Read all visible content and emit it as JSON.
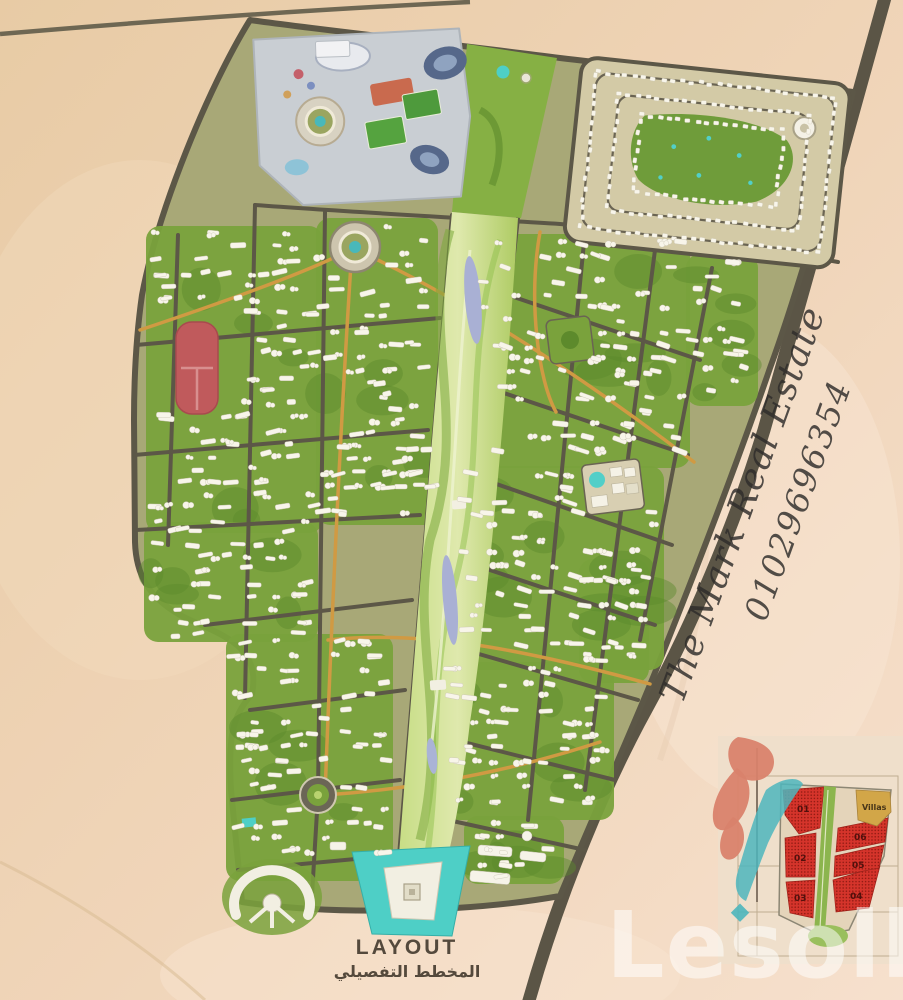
{
  "watermark": {
    "brand": "The Mark Real Estate",
    "phone": "01029696354"
  },
  "caption": {
    "title_en": "LAYOUT",
    "title_ar": "المخطط التفصيلي"
  },
  "portal_watermark": {
    "text": "Lesoll"
  },
  "inset_plan": {
    "zones": [
      {
        "id": "01"
      },
      {
        "id": "02"
      },
      {
        "id": "03"
      },
      {
        "id": "04"
      },
      {
        "id": "05"
      },
      {
        "id": "06"
      }
    ],
    "villas_label": "Villas",
    "zone_color": "#d5342b",
    "villas_color": "#d2a648",
    "spine_color": "#8cb54e"
  },
  "colors": {
    "desert": "#e9cda9",
    "desert_right": "#f6dfcc",
    "road_dark": "#5c5747",
    "road_orange": "#d09a43",
    "greenery": "#7aa23c",
    "park_spine": "#b9d36f",
    "water_lavender": "#a9b0d4",
    "water_turquoise": "#4ecfc6",
    "building_white": "#f8f5ea",
    "red_plot": "#c05a5c",
    "logo_salmon": "#d9826b",
    "logo_teal": "#4db6bd"
  }
}
